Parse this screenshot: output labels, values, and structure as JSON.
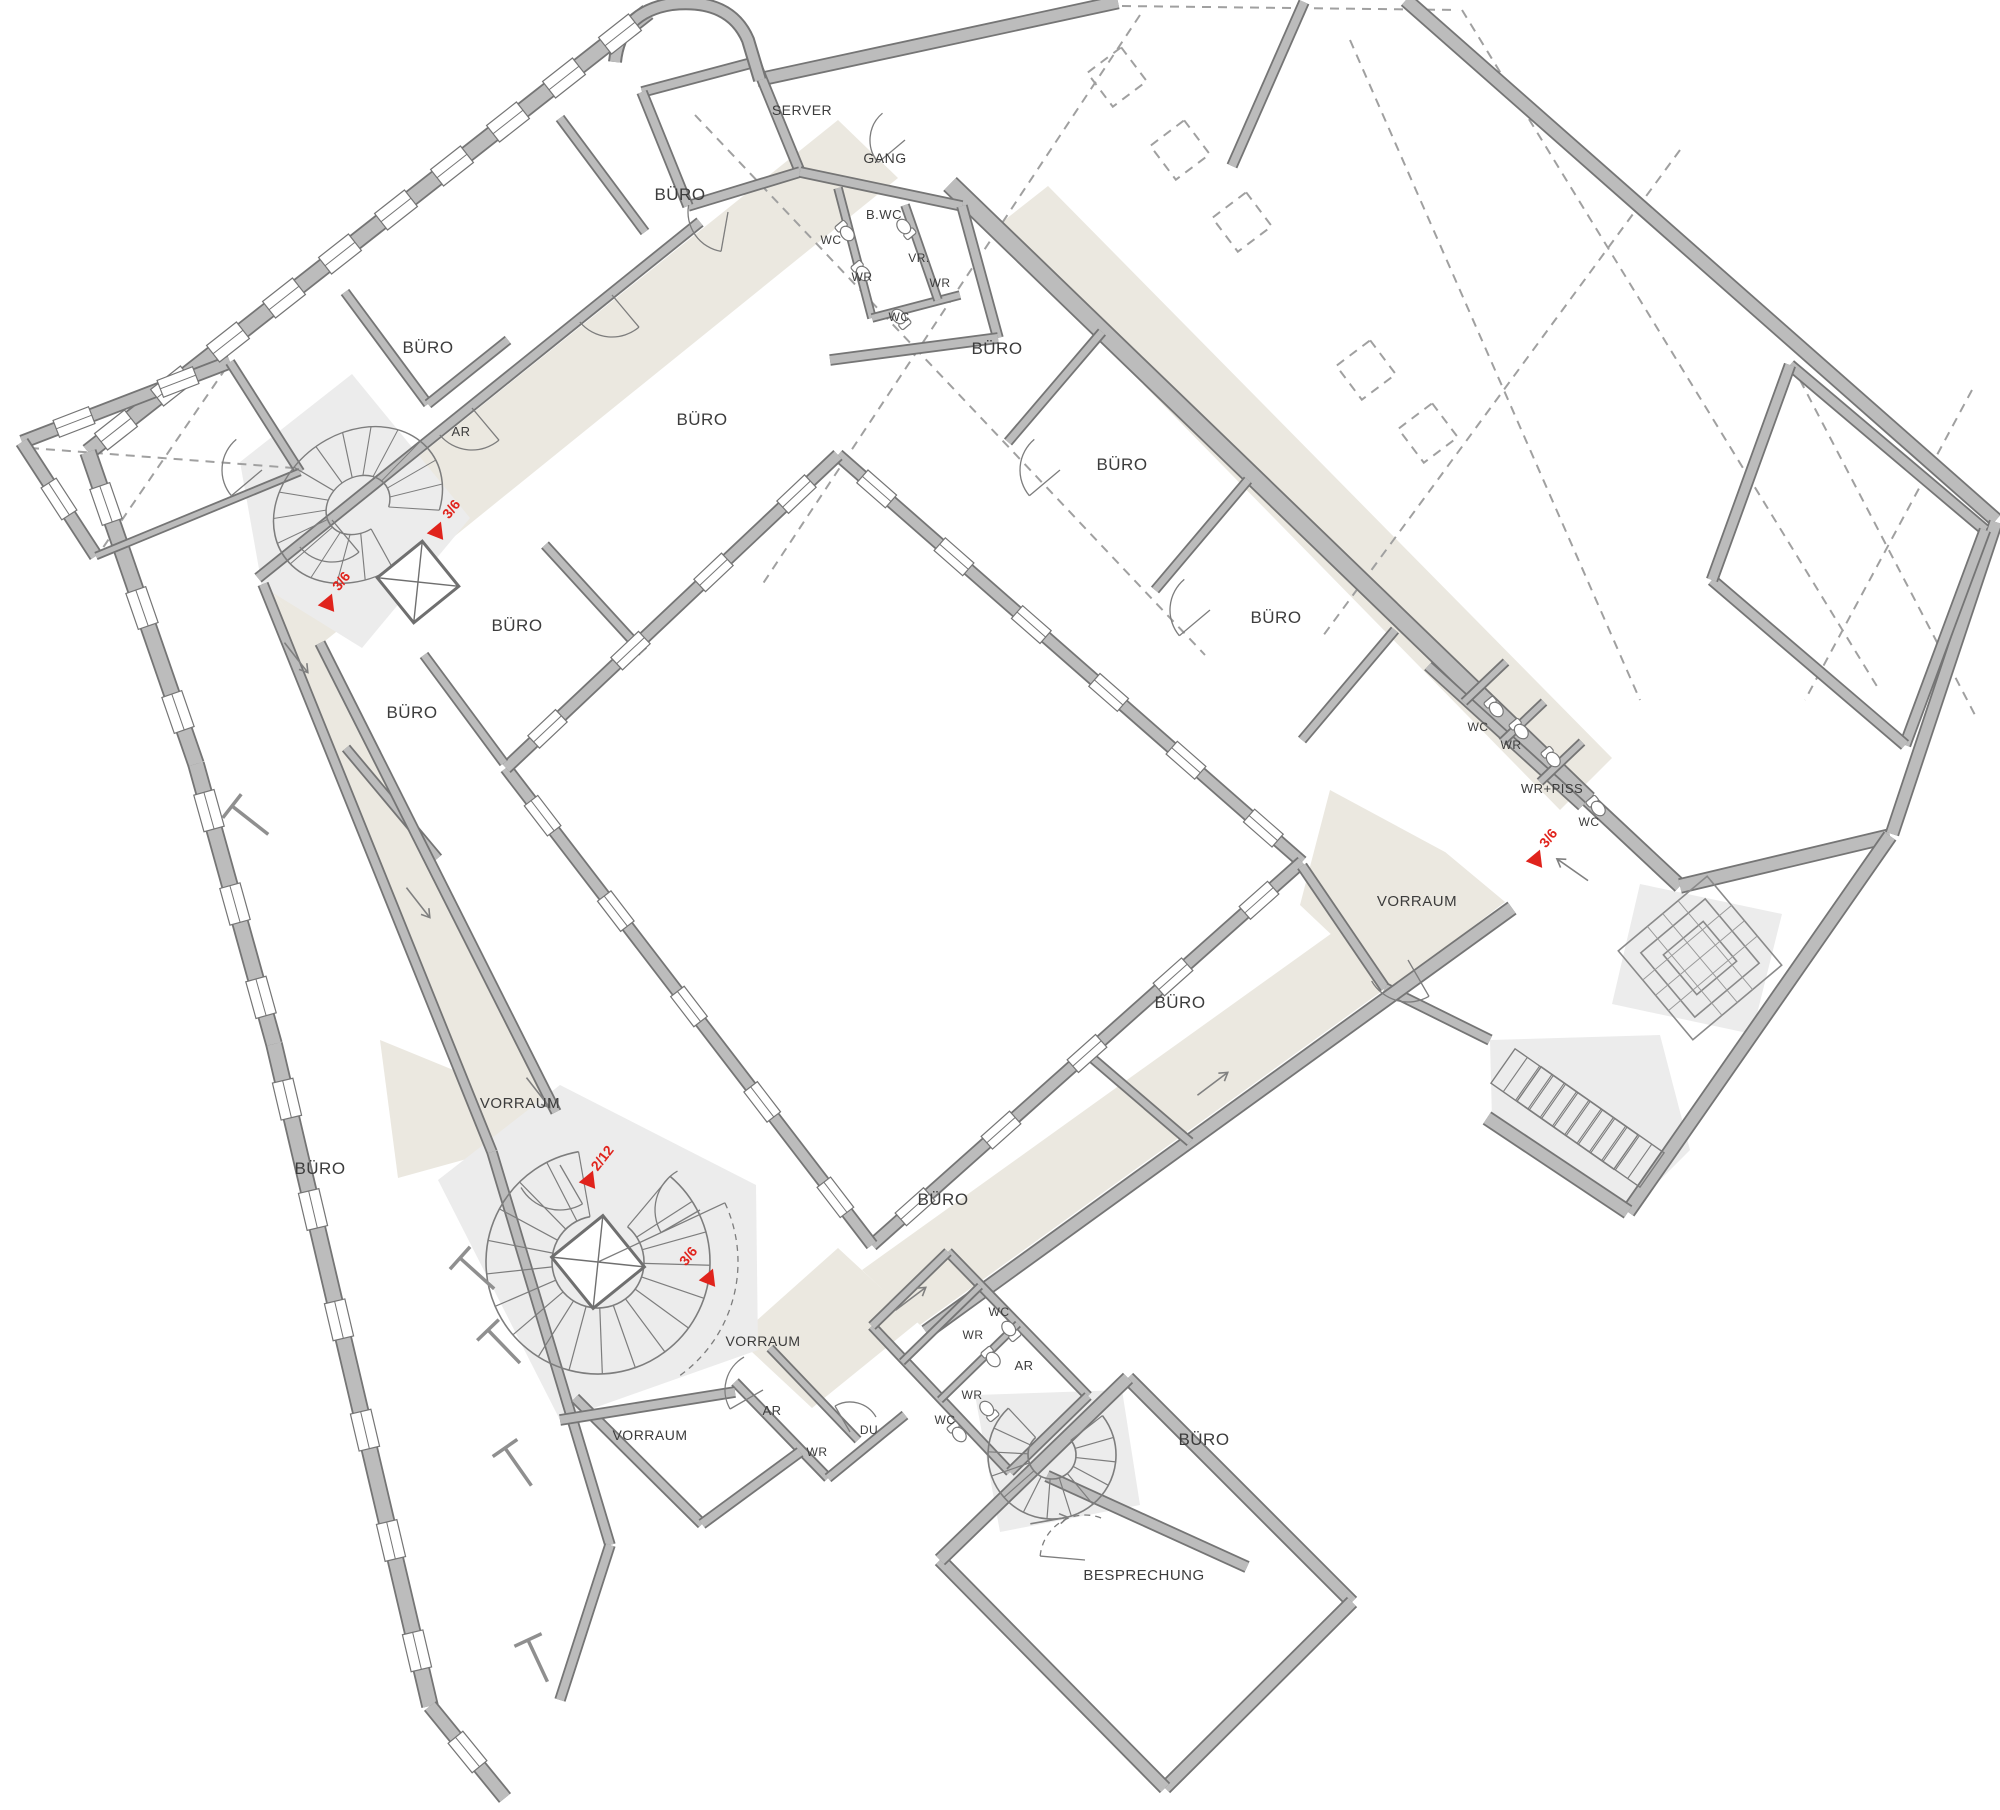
{
  "document": {
    "type": "floor-plan",
    "language": "de"
  },
  "colors": {
    "wall_fill": "#bcbcbc",
    "wall_outline": "#757575",
    "corridor_beige": "#ebe8e0",
    "stair_hall_gray": "#ececec",
    "thin_line": "#8a8a8a",
    "dashed_line": "#a0a0a0",
    "marker_red": "#e0231c",
    "label_text": "#3c3c3c",
    "background": "#ffffff"
  },
  "plan": {
    "labels": [
      {
        "text": "SERVER",
        "x": 802,
        "y": 115,
        "s": 14
      },
      {
        "text": "GANG",
        "x": 885,
        "y": 163,
        "s": 14
      },
      {
        "text": "B.WC",
        "x": 884,
        "y": 219,
        "s": 13
      },
      {
        "text": "WC",
        "x": 831,
        "y": 244,
        "s": 12
      },
      {
        "text": "WR",
        "x": 862,
        "y": 281,
        "s": 12
      },
      {
        "text": "VR.",
        "x": 919,
        "y": 262,
        "s": 12
      },
      {
        "text": "WR",
        "x": 940,
        "y": 287,
        "s": 12
      },
      {
        "text": "WC",
        "x": 899,
        "y": 321,
        "s": 12
      },
      {
        "text": "BÜRO",
        "x": 680,
        "y": 200,
        "s": 17
      },
      {
        "text": "BÜRO",
        "x": 428,
        "y": 353,
        "s": 17
      },
      {
        "text": "AR",
        "x": 461,
        "y": 436,
        "s": 13
      },
      {
        "text": "BÜRO",
        "x": 702,
        "y": 425,
        "s": 17
      },
      {
        "text": "BÜRO",
        "x": 997,
        "y": 354,
        "s": 17
      },
      {
        "text": "BÜRO",
        "x": 1122,
        "y": 470,
        "s": 17
      },
      {
        "text": "BÜRO",
        "x": 1276,
        "y": 623,
        "s": 17
      },
      {
        "text": "BÜRO",
        "x": 517,
        "y": 631,
        "s": 17
      },
      {
        "text": "BÜRO",
        "x": 412,
        "y": 718,
        "s": 17
      },
      {
        "text": "WC",
        "x": 1478,
        "y": 731,
        "s": 12
      },
      {
        "text": "WR",
        "x": 1511,
        "y": 749,
        "s": 12
      },
      {
        "text": "WR+PISS",
        "x": 1552,
        "y": 793,
        "s": 13
      },
      {
        "text": "WC",
        "x": 1589,
        "y": 826,
        "s": 12
      },
      {
        "text": "VORRAUM",
        "x": 1417,
        "y": 906,
        "s": 15
      },
      {
        "text": "BÜRO",
        "x": 1180,
        "y": 1008,
        "s": 17
      },
      {
        "text": "VORRAUM",
        "x": 520,
        "y": 1108,
        "s": 15
      },
      {
        "text": "BÜRO",
        "x": 320,
        "y": 1174,
        "s": 17
      },
      {
        "text": "BÜRO",
        "x": 943,
        "y": 1205,
        "s": 17
      },
      {
        "text": "VORRAUM",
        "x": 763,
        "y": 1346,
        "s": 14
      },
      {
        "text": "WC",
        "x": 999,
        "y": 1316,
        "s": 12
      },
      {
        "text": "WR",
        "x": 973,
        "y": 1339,
        "s": 12
      },
      {
        "text": "AR",
        "x": 1024,
        "y": 1370,
        "s": 13
      },
      {
        "text": "WR",
        "x": 972,
        "y": 1399,
        "s": 12
      },
      {
        "text": "WC",
        "x": 945,
        "y": 1424,
        "s": 12
      },
      {
        "text": "VORRAUM",
        "x": 650,
        "y": 1440,
        "s": 14
      },
      {
        "text": "AR",
        "x": 772,
        "y": 1415,
        "s": 13
      },
      {
        "text": "WR",
        "x": 817,
        "y": 1456,
        "s": 12
      },
      {
        "text": "DU",
        "x": 869,
        "y": 1434,
        "s": 12
      },
      {
        "text": "BÜRO",
        "x": 1204,
        "y": 1445,
        "s": 17
      },
      {
        "text": "BESPRECHUNG",
        "x": 1144,
        "y": 1580,
        "s": 15
      }
    ],
    "markers": [
      {
        "text": "3/6",
        "x": 455,
        "y": 512,
        "tx": 437,
        "ty": 530,
        "rot": -52
      },
      {
        "text": "3/6",
        "x": 345,
        "y": 584,
        "tx": 328,
        "ty": 602,
        "rot": -52
      },
      {
        "text": "2/12",
        "x": 606,
        "y": 1161,
        "tx": 589,
        "ty": 1179,
        "rot": -52
      },
      {
        "text": "3/6",
        "x": 692,
        "y": 1259,
        "tx": 709,
        "ty": 1277,
        "rot": -52
      },
      {
        "text": "3/6",
        "x": 1552,
        "y": 841,
        "tx": 1536,
        "ty": 858,
        "rot": -52
      }
    ]
  }
}
